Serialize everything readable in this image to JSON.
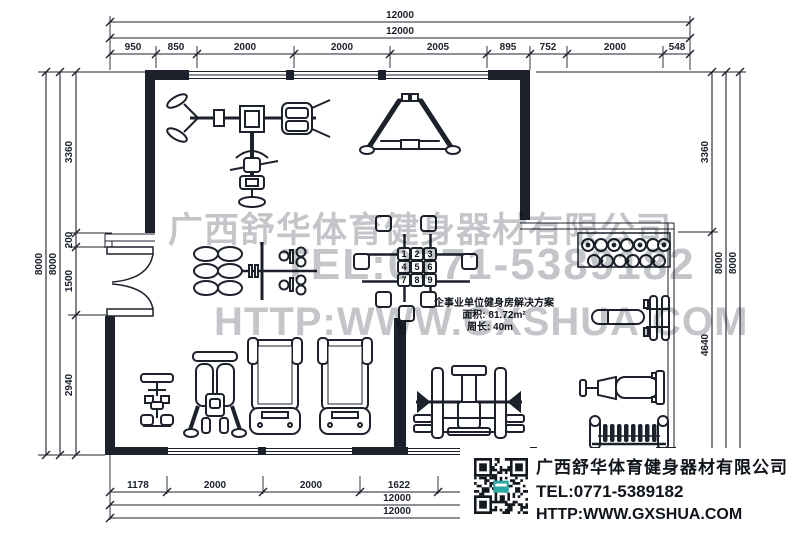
{
  "meta": {
    "ink": "#1c212b",
    "background": "#ffffff",
    "watermark_color": "#c3c5c9"
  },
  "dims": {
    "top": {
      "total1": "12000",
      "total2": "12000",
      "segments": [
        "950",
        "850",
        "2000",
        "2000",
        "2005",
        "895",
        "752",
        "2000",
        "548"
      ]
    },
    "left": {
      "outer": "8000",
      "inner": "8000",
      "segments": [
        "3360",
        "200",
        "1500",
        "2940"
      ]
    },
    "right": {
      "segments": [
        "3360",
        "4640"
      ],
      "inner": "8000",
      "outer": "8000"
    },
    "bottom": {
      "segments": [
        "1178",
        "2000",
        "2000",
        "1622"
      ],
      "total1": "12000",
      "total2": "12000"
    }
  },
  "plan": {
    "station_grid": [
      "1",
      "2",
      "3",
      "4",
      "5",
      "6",
      "7",
      "8",
      "9"
    ]
  },
  "solution_box": {
    "title": "企事业单位健身房解决方案",
    "area": "面积: 81.72m²",
    "perimeter": "周长: 40m"
  },
  "watermark": {
    "line1": "广西舒华体育健身器材有限公司",
    "line2": "TEL:0771-5389182",
    "line3": "HTTP:WWW.GXSHUA.COM"
  },
  "info_box": {
    "company": "广西舒华体育健身器材有限公司",
    "tel": "TEL:0771-5389182",
    "web": "HTTP:WWW.GXSHUA.COM",
    "qr_accent": "#2ba7a3"
  }
}
